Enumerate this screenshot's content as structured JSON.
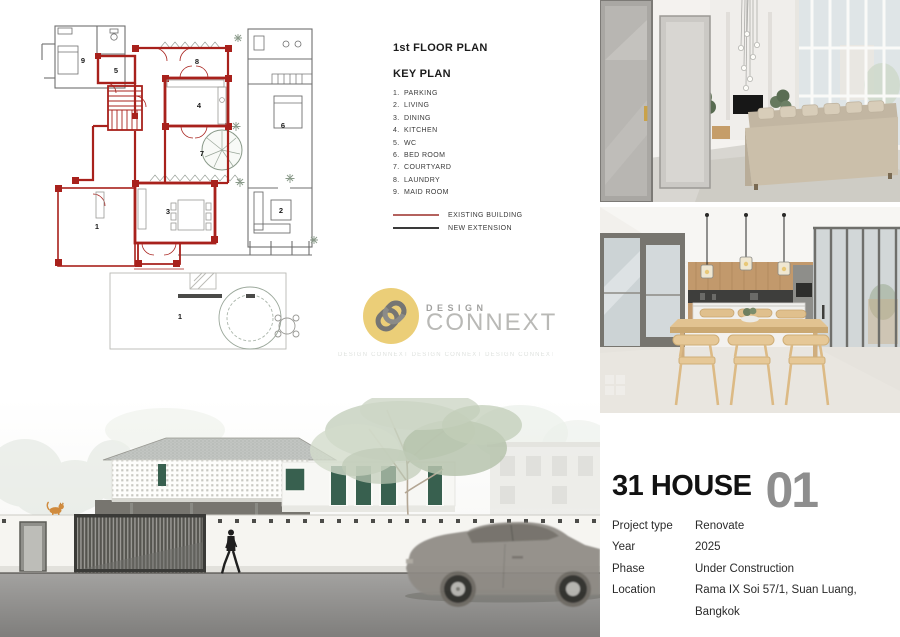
{
  "plan_section": {
    "title": "1st FLOOR PLAN",
    "key_plan_title": "KEY PLAN",
    "key_items": [
      {
        "num": "1.",
        "label": "PARKING"
      },
      {
        "num": "2.",
        "label": "LIVING"
      },
      {
        "num": "3.",
        "label": "DINING"
      },
      {
        "num": "4.",
        "label": "KITCHEN"
      },
      {
        "num": "5.",
        "label": "WC"
      },
      {
        "num": "6.",
        "label": "BED ROOM"
      },
      {
        "num": "7.",
        "label": "COURTYARD"
      },
      {
        "num": "8.",
        "label": "LAUNDRY"
      },
      {
        "num": "9.",
        "label": "MAID ROOM"
      }
    ],
    "legend": [
      {
        "label": "EXISTING BUILDING",
        "color": "#b4625e"
      },
      {
        "label": "NEW EXTENSION",
        "color": "#3a3a3a"
      }
    ],
    "room_labels": {
      "parking": "1",
      "living": "2",
      "dining": "3",
      "kitchen": "4",
      "wc": "5",
      "bedroom": "6",
      "courtyard": "7",
      "laundry": "8",
      "maid": "9",
      "yard": "1"
    }
  },
  "watermark": {
    "line1": "DESIGN",
    "line2": "CONNEXT",
    "tiled": "DESIGN CONNEXT  DESIGN CONNEXT  DESIGN CONNEXT  DESIGN CONNEXT"
  },
  "project_info": {
    "title": "31 HOUSE",
    "index": "01",
    "rows": [
      {
        "label": "Project type",
        "value": "Renovate"
      },
      {
        "label": "Year",
        "value": "2025"
      },
      {
        "label": "Phase",
        "value": "Under Construction"
      },
      {
        "label": "Location",
        "value": "Rama IX Soi 57/1, Suan Luang, Bangkok"
      }
    ]
  },
  "colors": {
    "existing_building_red": "#a8211c",
    "new_extension_gray": "#6b6b6b",
    "window_green": "#38604f",
    "logo_yellow": "#e7c45a",
    "index_number_gray": "#8e8e8e"
  }
}
